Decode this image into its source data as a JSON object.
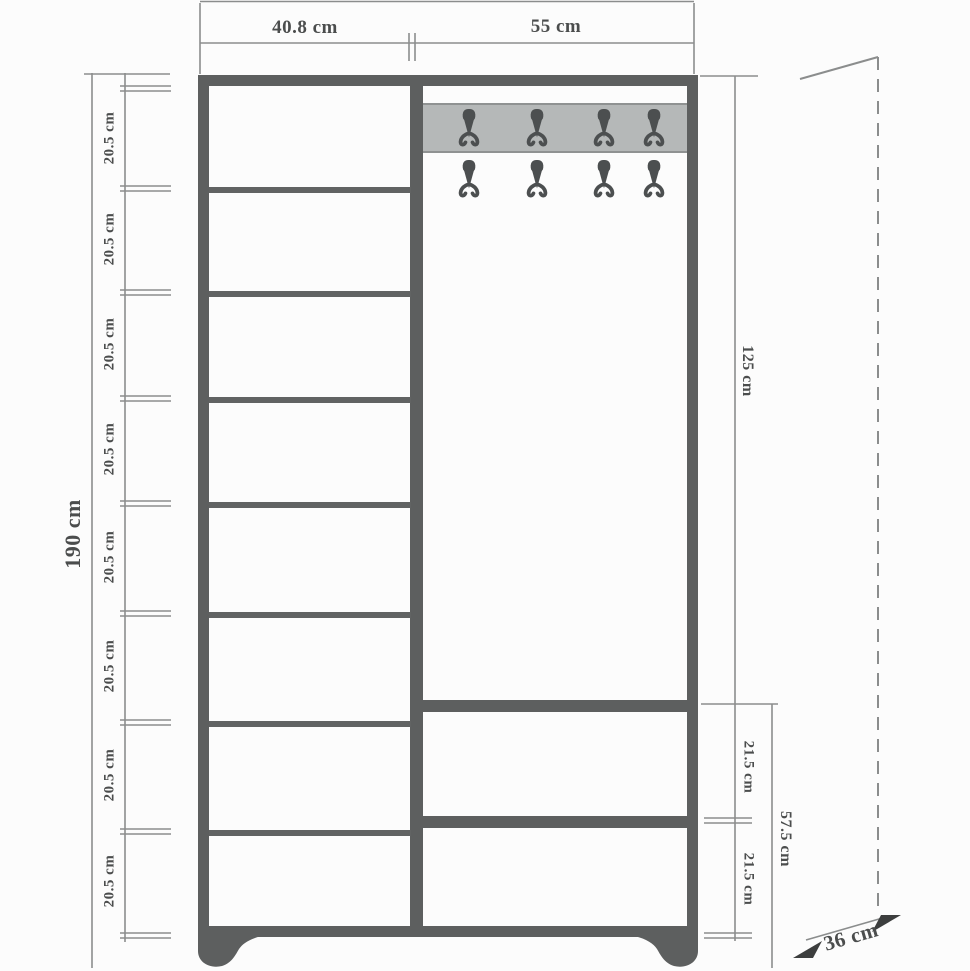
{
  "diagram": {
    "type": "furniture-dimension-drawing",
    "subject": "hallway unit: shelf column, coat-hook panel and two drawers on bracket feet",
    "units": "cm"
  },
  "dimensions": {
    "top_width_left": "40.8 cm",
    "top_width_right": "55 cm",
    "total_height": "190 cm",
    "left_segments": [
      "20.5 cm",
      "20.5 cm",
      "20.5 cm",
      "20.5 cm",
      "20.5 cm",
      "20.5 cm",
      "20.5 cm",
      "20.5 cm"
    ],
    "right_upper_height": "125 cm",
    "right_lower_segments": [
      "21.5 cm",
      "21.5 cm"
    ],
    "right_lower_total": "57.5 cm",
    "depth": "36 cm"
  },
  "cabinet": {
    "left_column_compartments": 8,
    "hook_rows": 2,
    "hooks_per_row": 4,
    "drawer_compartments": 2
  },
  "colors": {
    "frame": "#5d5f5f",
    "rail_fill": "#b5b8b8",
    "rail_border": "#8f9292",
    "hook": "#4c4f50",
    "dimension_line": "#8b8d8d",
    "label_text": "#4b4d4d",
    "background": "#fcfcfc"
  }
}
